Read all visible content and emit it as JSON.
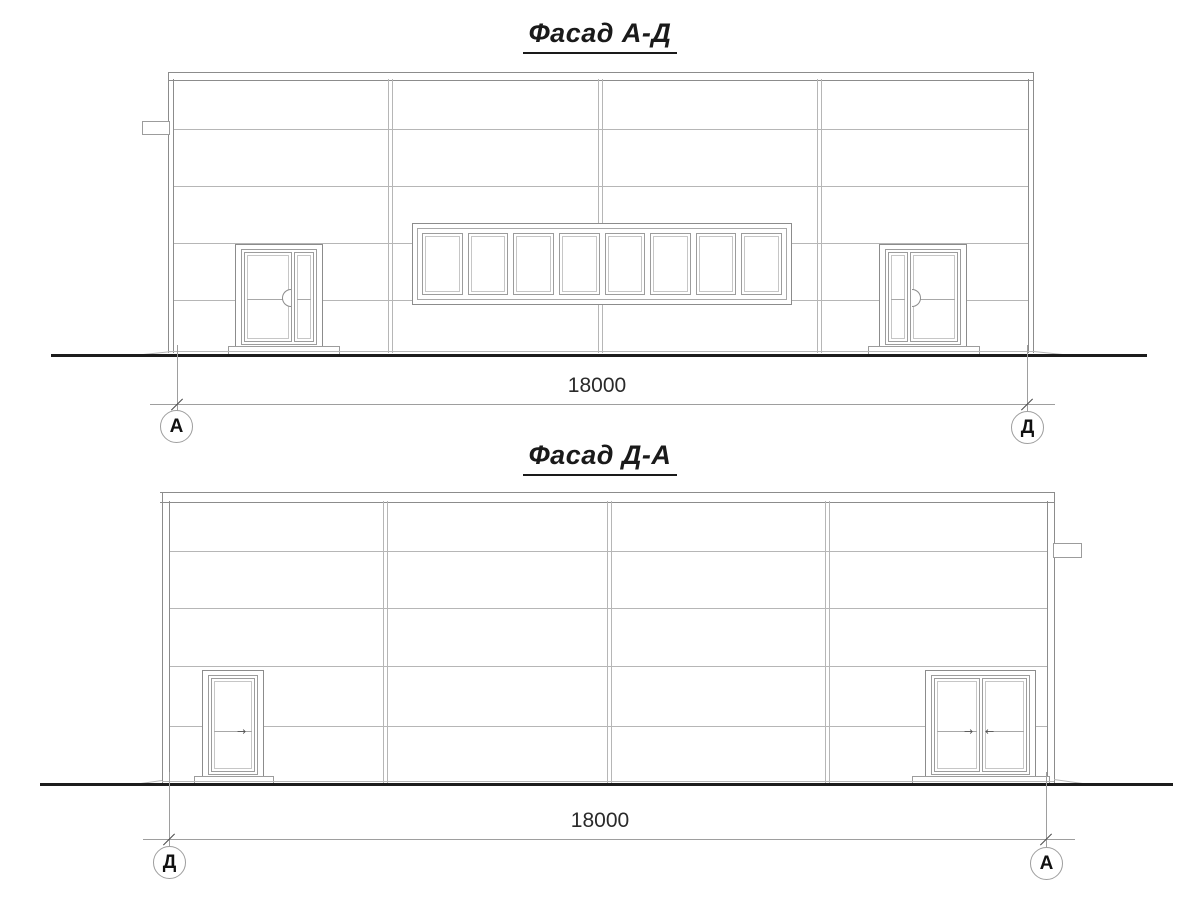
{
  "colors": {
    "thin_line": "#a8a8a8",
    "panel_line": "#b6b6b6",
    "wall_line": "#8c8c8c",
    "detail_line": "#9c9c9c",
    "glass_line": "#c6c6c6",
    "ground": "#1c1c1c",
    "dim": "#9e9e9e",
    "tick": "#4a4a4a",
    "arrow": "#555555",
    "text": "#1a1a1a"
  },
  "facade_top": {
    "title": "Фасад А-Д",
    "dimension_value": "18000",
    "axis_left": "А",
    "axis_right": "Д"
  },
  "facade_bottom": {
    "title": "Фасад Д-А",
    "dimension_value": "18000",
    "axis_left": "Д",
    "axis_right": "А"
  }
}
